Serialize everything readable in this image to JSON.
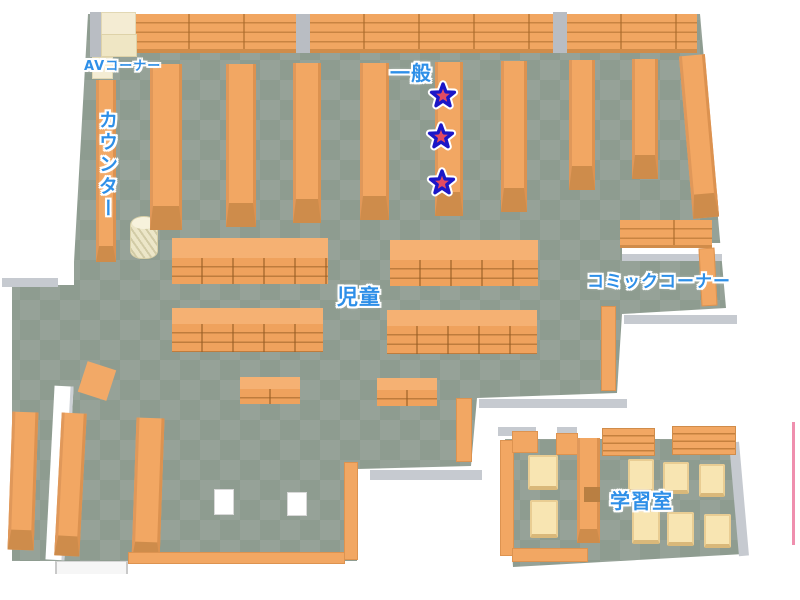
{
  "map": {
    "title": "図書館フロアマップ",
    "areas": [
      {
        "id": "av_corner",
        "label": "AVコーナー"
      },
      {
        "id": "counter",
        "label": "カウンター"
      },
      {
        "id": "general",
        "label": "一般"
      },
      {
        "id": "children",
        "label": "児童"
      },
      {
        "id": "comic_corner",
        "label": "コミックコーナー"
      },
      {
        "id": "study_room",
        "label": "学習室"
      }
    ],
    "markers": {
      "type": "star",
      "count": 3,
      "positions": [
        {
          "x": 443,
          "y": 96
        },
        {
          "x": 441,
          "y": 137
        },
        {
          "x": 442,
          "y": 183
        }
      ]
    },
    "colors": {
      "label_blue": "#2e8fe8",
      "floor_dark": "#8e9c90",
      "floor_light": "#96a298",
      "shelf_orange": "#f2a763",
      "shelf_front": "#ce8c4b",
      "wall_white": "#ffffff",
      "wall_shade": "#c6cad0",
      "desk_cream": "#f8e5b2",
      "star_fill": "#ed5a70",
      "star_outline": "#1b16c8",
      "edge_line_pink": "#ef8fae"
    }
  }
}
